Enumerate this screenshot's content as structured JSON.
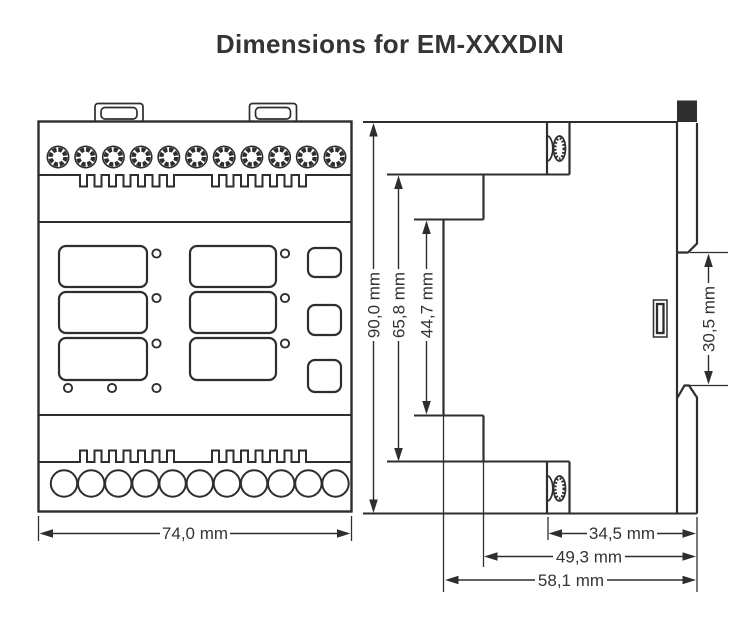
{
  "title": "Dimensions for EM-XXXDIN",
  "colors": {
    "line": "#2e2e2e",
    "text": "#343434",
    "background": "#ffffff"
  },
  "dimensions": {
    "overall_height": "90,0 mm",
    "cover_height": "65,8 mm",
    "face_height": "44,7 mm",
    "din_gap_height": "30,5 mm",
    "overall_width": "74,0 mm",
    "rear_depth": "34,5 mm",
    "mid_depth": "49,3 mm",
    "overall_depth": "58,1 mm"
  }
}
